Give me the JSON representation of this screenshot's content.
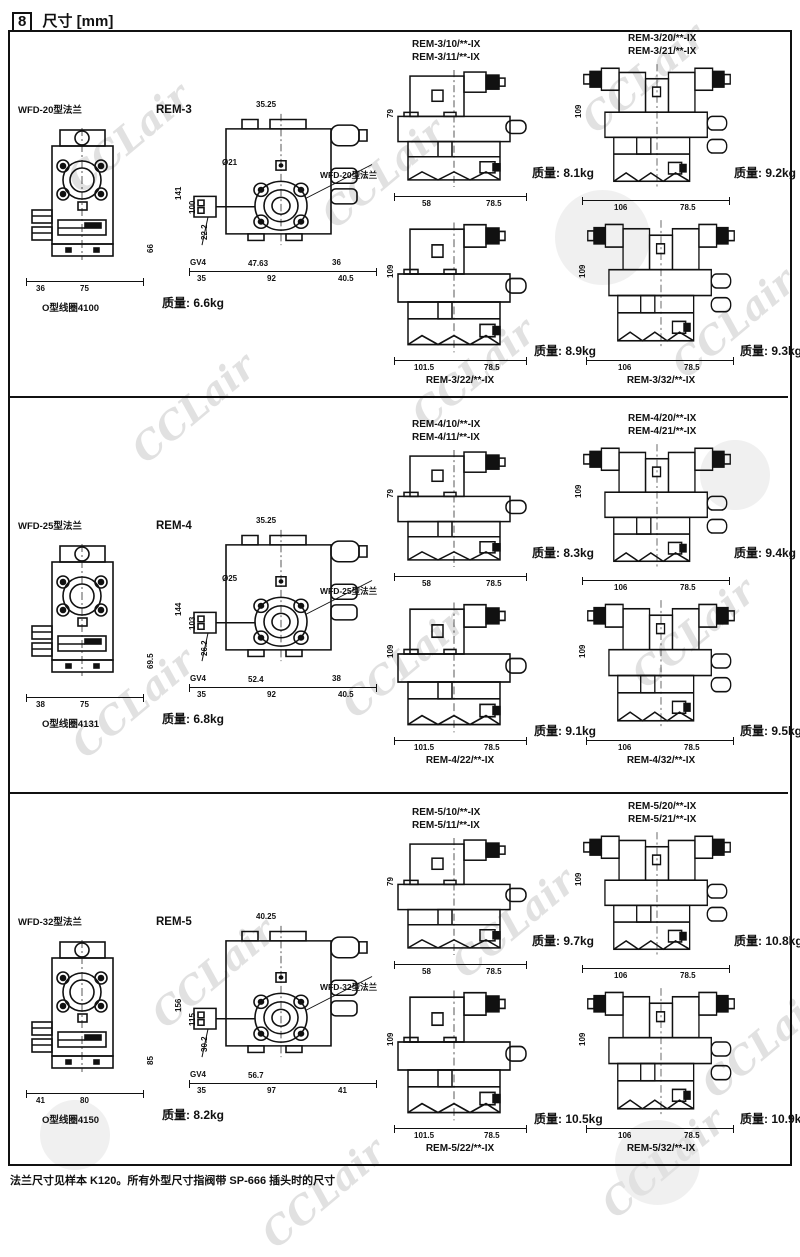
{
  "page": {
    "header_number": "8",
    "title": "尺寸 [mm]",
    "footer": "法兰尺寸见样本 K120。所有外型尺寸指阀带 SP-666 插头时的尺寸",
    "watermark": "CCLair"
  },
  "sections": [
    {
      "flange": {
        "label": "WFD-20型法兰",
        "coil_note": "O型线圈4100",
        "dims": {
          "left": "36",
          "width": "75",
          "height": "66"
        }
      },
      "side_view": {
        "label": "REM-3",
        "flange_label": "WFD-20型法兰",
        "weight": "质量: 6.6kg",
        "dims": {
          "top": "35.25",
          "bore": "Ø21",
          "h1": "141",
          "h2": "100",
          "left_small": "22.2",
          "port": "GV4",
          "bolt": "47.63",
          "right_small": "36",
          "b1": "35",
          "b2": "92",
          "b3": "40.5"
        }
      },
      "variants": [
        {
          "labels": [
            "REM-3/10/**-IX",
            "REM-3/11/**-IX"
          ],
          "weight": "质量: 8.1kg",
          "dims": {
            "height": "79",
            "w1": "58",
            "w2": "78.5"
          }
        },
        {
          "labels": [
            "REM-3/20/**-IX",
            "REM-3/21/**-IX"
          ],
          "weight": "质量: 9.2kg",
          "dims": {
            "height": "109",
            "w1": "106",
            "w2": "78.5"
          }
        },
        {
          "labels": [
            "REM-3/22/**-IX"
          ],
          "weight": "质量: 8.9kg",
          "dims": {
            "height": "109",
            "w1": "101.5",
            "w2": "78.5"
          }
        },
        {
          "labels": [
            "REM-3/32/**-IX"
          ],
          "weight": "质量: 9.3kg",
          "dims": {
            "height": "109",
            "w1": "106",
            "w2": "78.5"
          }
        }
      ]
    },
    {
      "flange": {
        "label": "WFD-25型法兰",
        "coil_note": "O型线圈4131",
        "dims": {
          "left": "38",
          "width": "75",
          "height": "69.5"
        }
      },
      "side_view": {
        "label": "REM-4",
        "flange_label": "WFD-25型法兰",
        "weight": "质量: 6.8kg",
        "dims": {
          "top": "35.25",
          "bore": "Ø25",
          "h1": "144",
          "h2": "103",
          "left_small": "26.2",
          "port": "GV4",
          "bolt": "52.4",
          "right_small": "38",
          "b1": "35",
          "b2": "92",
          "b3": "40.5"
        }
      },
      "variants": [
        {
          "labels": [
            "REM-4/10/**-IX",
            "REM-4/11/**-IX"
          ],
          "weight": "质量: 8.3kg",
          "dims": {
            "height": "79",
            "w1": "58",
            "w2": "78.5"
          }
        },
        {
          "labels": [
            "REM-4/20/**-IX",
            "REM-4/21/**-IX"
          ],
          "weight": "质量: 9.4kg",
          "dims": {
            "height": "109",
            "w1": "106",
            "w2": "78.5"
          }
        },
        {
          "labels": [
            "REM-4/22/**-IX"
          ],
          "weight": "质量: 9.1kg",
          "dims": {
            "height": "109",
            "w1": "101.5",
            "w2": "78.5"
          }
        },
        {
          "labels": [
            "REM-4/32/**-IX"
          ],
          "weight": "质量: 9.5kg",
          "dims": {
            "height": "109",
            "w1": "106",
            "w2": "78.5"
          }
        }
      ]
    },
    {
      "flange": {
        "label": "WFD-32型法兰",
        "coil_note": "O型线圈4150",
        "dims": {
          "left": "41",
          "width": "80",
          "height": "85"
        }
      },
      "side_view": {
        "label": "REM-5",
        "flange_label": "WFD-32型法兰",
        "weight": "质量: 8.2kg",
        "dims": {
          "top": "40.25",
          "h1": "156",
          "h2": "115",
          "left_small": "30.2",
          "port": "GV4",
          "bolt": "56.7",
          "b1": "35",
          "b2": "97",
          "b3": "41"
        }
      },
      "variants": [
        {
          "labels": [
            "REM-5/10/**-IX",
            "REM-5/11/**-IX"
          ],
          "weight": "质量: 9.7kg",
          "dims": {
            "height": "79",
            "w1": "58",
            "w2": "78.5"
          }
        },
        {
          "labels": [
            "REM-5/20/**-IX",
            "REM-5/21/**-IX"
          ],
          "weight": "质量: 10.8kg",
          "dims": {
            "height": "109",
            "w1": "106",
            "w2": "78.5"
          }
        },
        {
          "labels": [
            "REM-5/22/**-IX"
          ],
          "weight": "质量: 10.5kg",
          "dims": {
            "height": "109",
            "w1": "101.5",
            "w2": "78.5"
          }
        },
        {
          "labels": [
            "REM-5/32/**-IX"
          ],
          "weight": "质量: 10.9kg",
          "dims": {
            "height": "109",
            "w1": "106",
            "w2": "78.5"
          }
        }
      ]
    }
  ]
}
